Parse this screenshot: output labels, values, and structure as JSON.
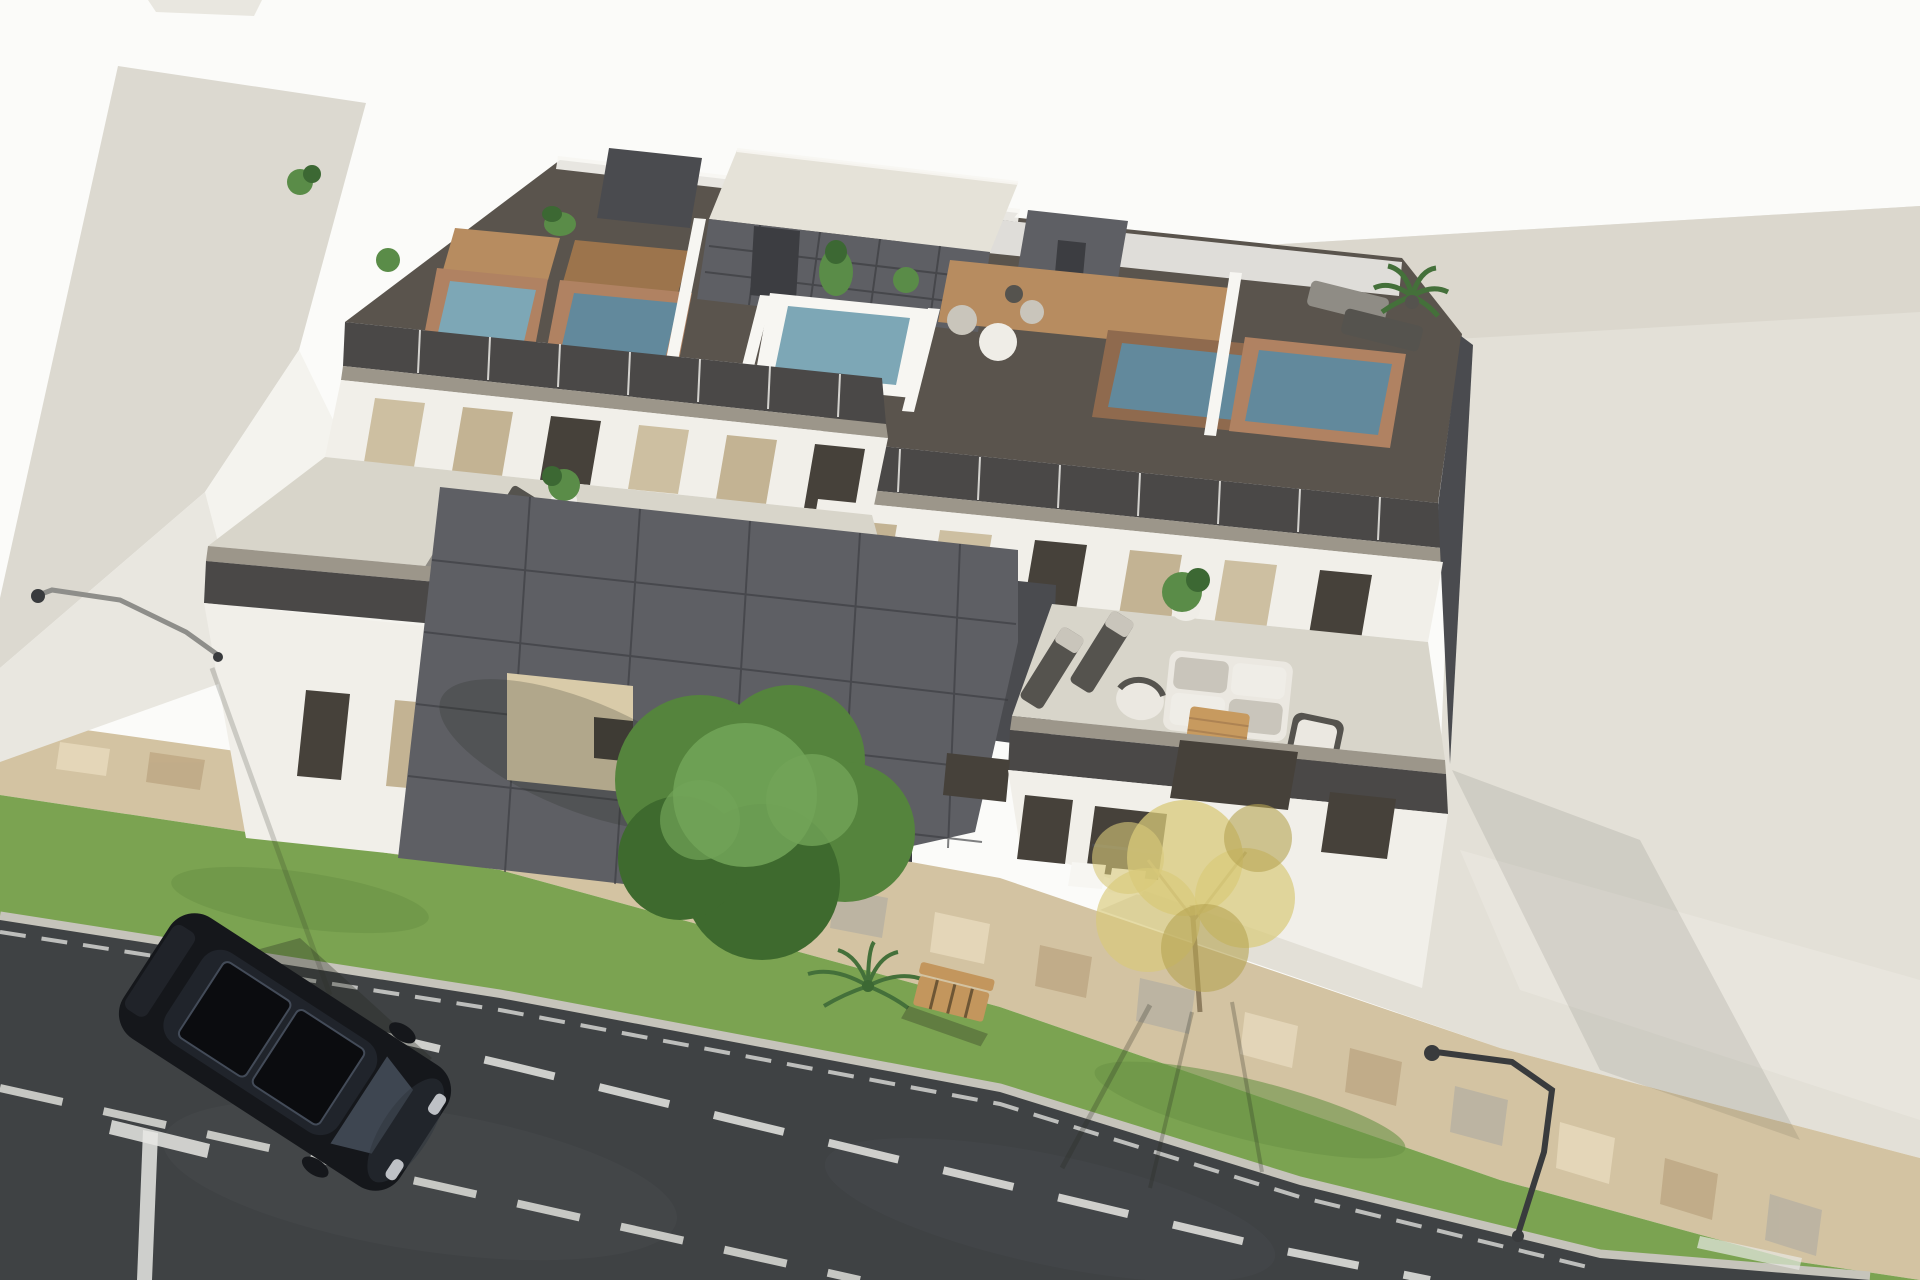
{
  "scene": {
    "description": "Aerial 3D architectural rendering of a modern three-storey apartment building with private rooftop terraces and plunge pools, street-side parking, lawn strip, paved mosaic walkway and a parked black car",
    "objects": [
      "neighbor building roof",
      "apartment building",
      "rooftop plunge pools",
      "rooftop penthouse volumes",
      "glass railings",
      "middle-floor terraces with pools",
      "outdoor sofa set",
      "sun loungers",
      "potted plants",
      "mosaic paver walkway",
      "lawn strip with bench and shrub",
      "green tree",
      "yellow tree",
      "street lamps",
      "asphalt road with lane markings",
      "parked black car"
    ],
    "pool_count_rooftop": 5,
    "pool_count_terrace": 3
  },
  "colors": {
    "bg": "#fbfbf9",
    "distant_roof": "#e9e7e0",
    "neighbor_roof": "#dcd9d0",
    "neighbor_wall_bright": "#f4f3ee",
    "neighbor_wall_shadow": "#e9e7e0",
    "pavement": "#e3e0d7",
    "pavement_shade": "#d8d5ca",
    "pavement_light": "#eceae2",
    "walkway": "#d3c3a2",
    "walkway_tile_light": "#e6d9bc",
    "walkway_tile_dark": "#bfa985",
    "walkway_tile_gray": "#b8b2a2",
    "grass": "#7ba351",
    "grass_dark": "#6b9246",
    "curb": "#c6c4bb",
    "road": "#3f4244",
    "road_light": "#4d5052",
    "marking": "#e8e8e4",
    "white_wall": "#f1efe9",
    "white_wall_shadow": "#ddd9cf",
    "fascia": "#9c968a",
    "dark_band": "#4a4847",
    "deck_dark": "#5a544d",
    "anthracite": "#5e5f64",
    "anthracite_dark": "#4a4b4f",
    "anthracite_seam": "#3c3d41",
    "penthouse_roof": "#e5e2d8",
    "window_tan": "#c3b393",
    "window_dark": "#46413a",
    "curtain": "#cdbfa1",
    "reveal_beige": "#d9cba9",
    "pool_water": "#7da7b6",
    "pool_water_deep": "#62899c",
    "pool_brick": "#b08262",
    "pool_brick_dark": "#8f6a4e",
    "wood": "#b78c60",
    "wood_dark": "#9c744c",
    "white_trim": "#f7f6f2",
    "plant_green": "#5a8c48",
    "plant_dark": "#3c6833",
    "palm_green": "#44703a",
    "pot_white": "#efede7",
    "sofa_white": "#ebe8e1",
    "cushion": "#c9c5bb",
    "lounger": "#8f8c85",
    "lounger_dark": "#55534e",
    "table_wood": "#c79a5f",
    "tree_green": "#55843d",
    "tree_green_light": "#72a458",
    "tree_green_dark": "#3e6a2e",
    "tree_trunk": "#8e7d5f",
    "tree_yellow": "#d8ca79",
    "tree_yellow_dark": "#b5a451",
    "bench_wood": "#c3965d",
    "bench_dark": "#6e5635",
    "car_body": "#15171b",
    "car_body_light": "#2e333b",
    "car_glass": "#20242b",
    "car_glass_light": "#434b58",
    "car_detail": "#0b0c0f",
    "headlight": "#d9dde2",
    "lamp_gray": "#8e8e8a",
    "lamp_dark": "#393b3d",
    "shadow": "#26271f"
  }
}
